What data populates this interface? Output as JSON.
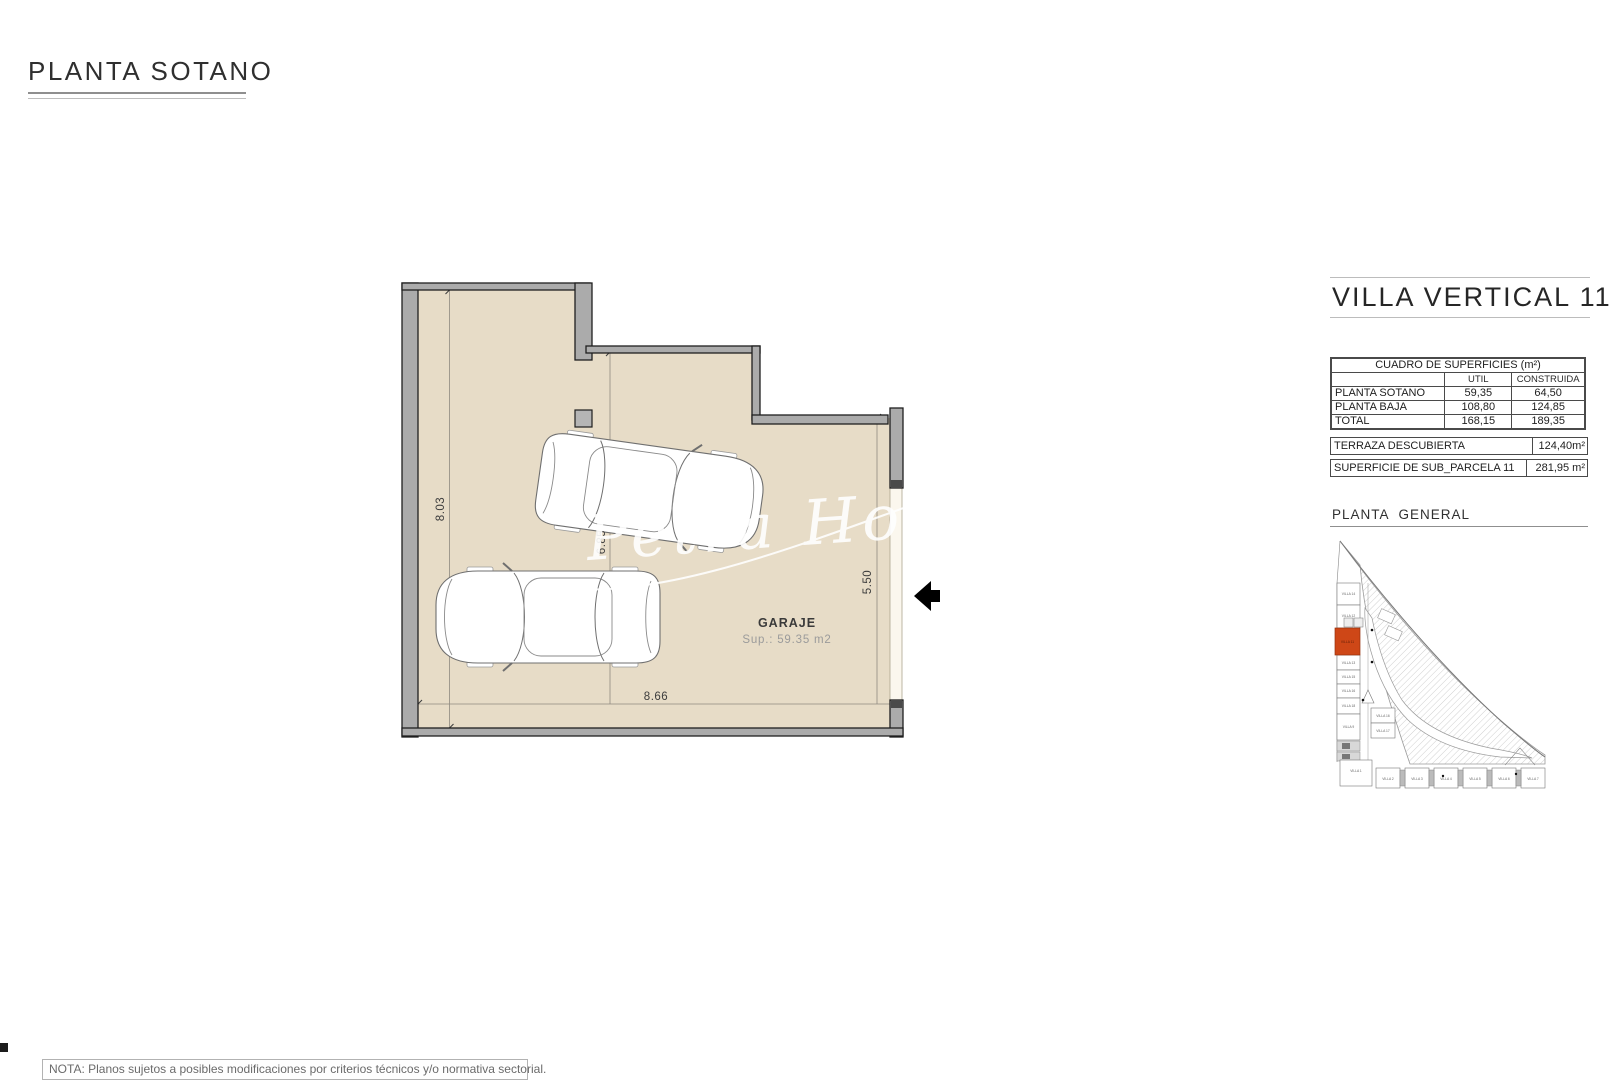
{
  "page": {
    "title": "PLANTA SOTANO"
  },
  "plan": {
    "room_label": "GARAJE",
    "room_area": "Sup.: 59.35 m2",
    "dims": {
      "left": "8.03",
      "middle": "6.85",
      "right": "5.50",
      "bottom": "8.66"
    },
    "watermark": "Petra Ho"
  },
  "panel": {
    "title": "VILLA VERTICAL 11",
    "table": {
      "title": "CUADRO DE SUPERFICIES (m²)",
      "col_util": "UTIL",
      "col_construida": "CONSTRUIDA",
      "rows": [
        {
          "label": "PLANTA SOTANO",
          "util": "59,35",
          "construida": "64,50"
        },
        {
          "label": "PLANTA BAJA",
          "util": "108,80",
          "construida": "124,85"
        },
        {
          "label": "TOTAL",
          "util": "168,15",
          "construida": "189,35"
        }
      ]
    },
    "terraza_label": "TERRAZA DESCUBIERTA",
    "terraza_value": "124,40m²",
    "parcela_label": "SUPERFICIE DE SUB_PARCELA 11",
    "parcela_value": "281,95 m²",
    "minimap_title": "PLANTA GENERAL",
    "minimap": {
      "left_villas": [
        "VILLA 14",
        "VILLA 12",
        "VILLA 11",
        "VILLA 13",
        "VILLA 15",
        "VILLA 16",
        "VILLA 18",
        "VILLA 9"
      ],
      "center_villas": [
        "VILLA 16",
        "VILLA 17"
      ],
      "bottom_villas": [
        "VILLA 1",
        "VILLA 2",
        "VILLA 3",
        "VILLA 4",
        "VILLA 5",
        "VILLA 6",
        "VILLA 7"
      ],
      "highlight": "VILLA 11"
    }
  },
  "note": {
    "text": "NOTA: Planos sujetos a posibles modificaciones por criterios técnicos y/o normativa sectorial."
  },
  "colors": {
    "highlight": "#ce4717",
    "plan_fill": "#e7dcc7",
    "wall_gray": "#ababab"
  }
}
